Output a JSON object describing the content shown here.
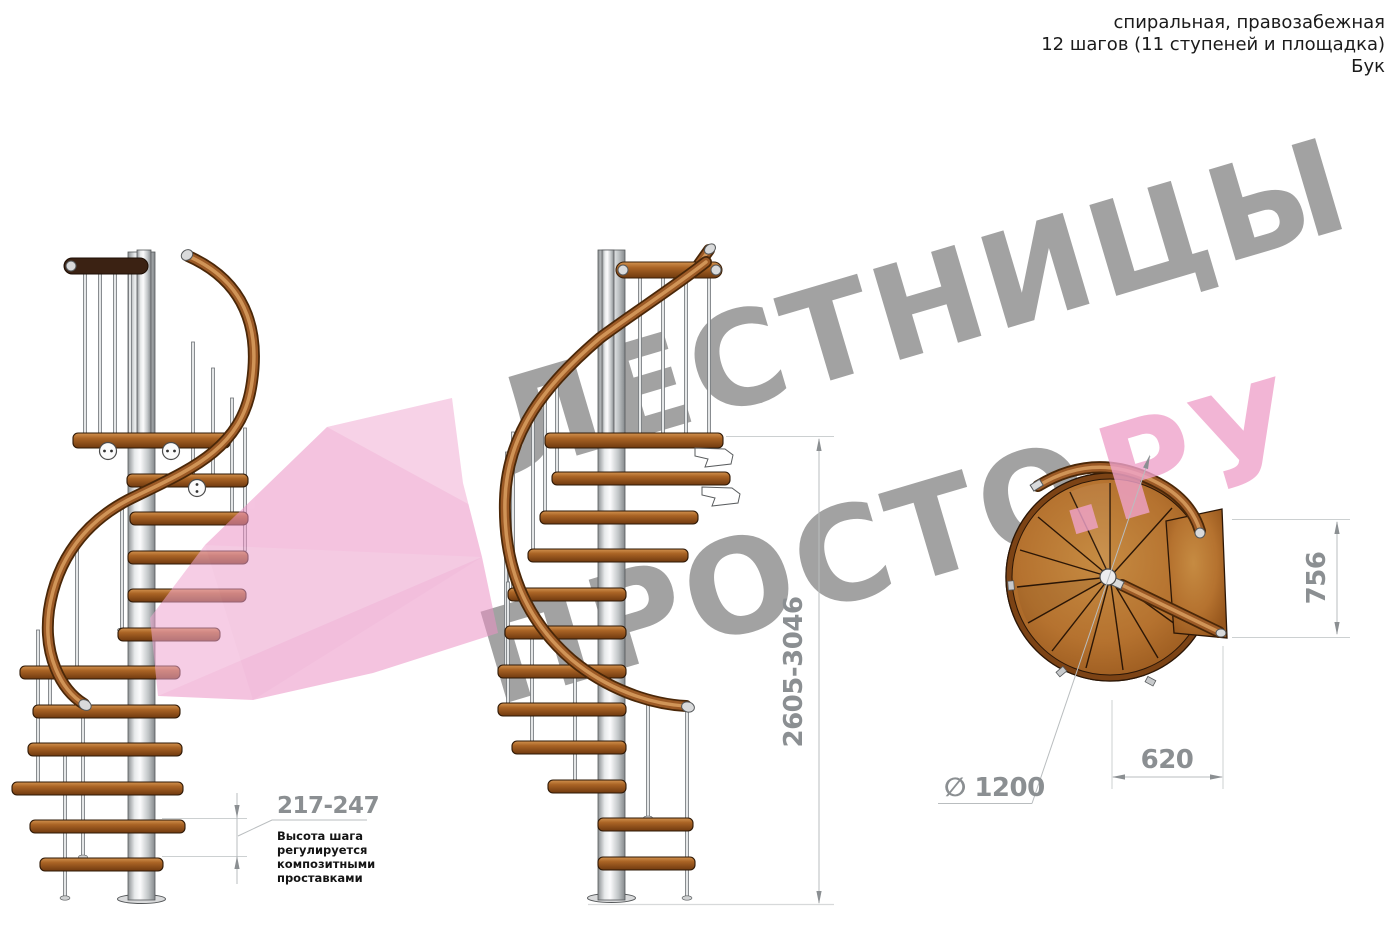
{
  "header": {
    "line1": "спиральная, правозабежная",
    "line2": "12 шагов (11 ступеней и площадка)",
    "line3": "Бук"
  },
  "watermark": {
    "line1": "ЛЕСТНИЦЫ",
    "line2_gray": "ПРОСТО",
    "line2_accent": ".РУ",
    "gray_color": "#a2a2a2",
    "accent_color": "#f0a3cb",
    "arrow_color": "#ec93c6"
  },
  "dimensions": {
    "total_height": "2605-3046",
    "step_height": "217-247",
    "landing_depth": "756",
    "landing_width": "620",
    "diameter": "∅ 1200"
  },
  "annotation": {
    "lines": [
      "Высота шага",
      "регулируется",
      "композитными",
      "проставками"
    ]
  },
  "colors": {
    "wood": "#b5722f",
    "wood_dark": "#6f3a0f",
    "metal_light": "#f2f3f4",
    "metal_dark": "#8d9194",
    "dimension_gray": "#8b8f92",
    "text_black": "#1b1b1b"
  }
}
